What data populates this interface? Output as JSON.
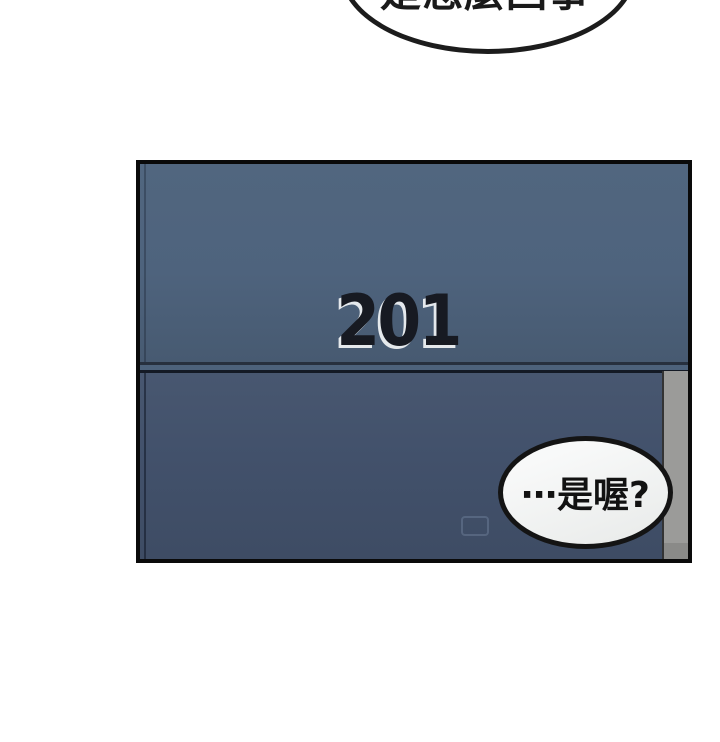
{
  "top_bubble": {
    "text": "是怎麼回事"
  },
  "panel": {
    "door": {
      "room_number": "201"
    },
    "speech_bubble": {
      "text": "⋯是喔?"
    }
  },
  "colors": {
    "page_background": "#ffffff",
    "panel_border": "#0a0a0a",
    "door_upper": "#4e637d",
    "door_lower": "#41506a",
    "divider_dark": "#141a25",
    "frame_strip": "#9b9b99",
    "room_number_text": "#171a22",
    "room_number_highlight": "#f6f8fa",
    "bubble_fill": "#f2f3f3",
    "bubble_outline": "#141414"
  }
}
